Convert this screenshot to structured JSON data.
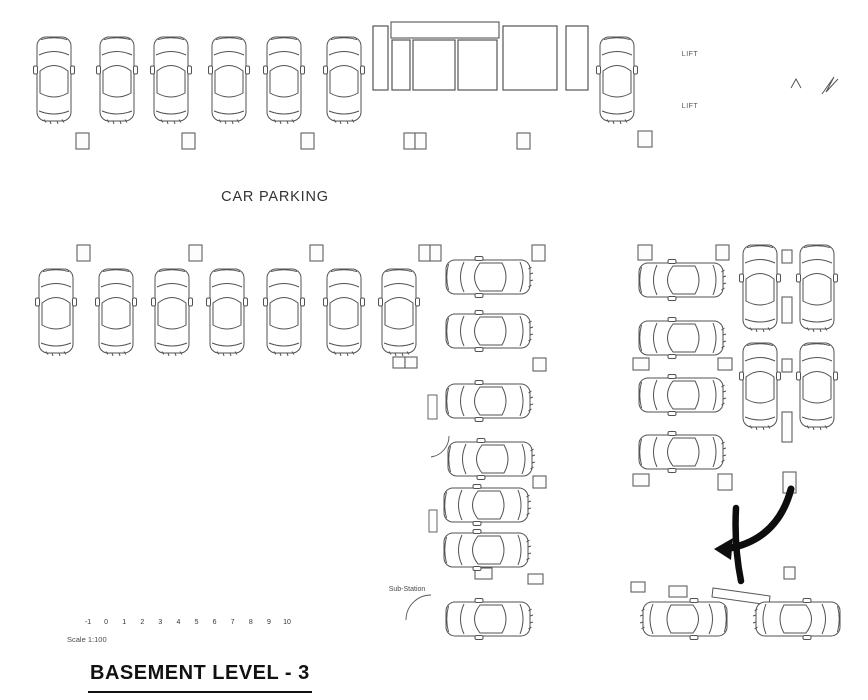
{
  "labels": {
    "car_parking": "CAR PARKING",
    "lift_upper": "LIFT",
    "lift_lower": "LIFT",
    "substation": "Sub-Station",
    "scale_note": "Scale 1:100",
    "title": "BASEMENT LEVEL - 3"
  },
  "colors": {
    "wall": "#3d3d3d",
    "line": "#555555",
    "pillar": "#5f5f5f",
    "car": "#525252",
    "dashdot": "#7a7a7a",
    "arrow": "#0d0d0d",
    "background": "#ffffff",
    "text": "#262626"
  },
  "scale_bar": {
    "labels": [
      "-1",
      "0",
      "1",
      "2",
      "3",
      "4",
      "5",
      "6",
      "7",
      "8",
      "9",
      "10"
    ],
    "x_start": 88,
    "x_end": 287,
    "y": 615,
    "tick_top": 607,
    "tick_bottom": 616
  },
  "geometry": {
    "wall_lines": [
      [
        20,
        15,
        862,
        15
      ],
      [
        29,
        24,
        853,
        24
      ],
      [
        862,
        15,
        862,
        682
      ],
      [
        853,
        24,
        853,
        673
      ],
      [
        862,
        682,
        381,
        646
      ],
      [
        853,
        673,
        388,
        640
      ],
      [
        381,
        646,
        381,
        368
      ],
      [
        387,
        640,
        387,
        368
      ],
      [
        7,
        368,
        437,
        368
      ],
      [
        15,
        358,
        437,
        358
      ],
      [
        7,
        368,
        20,
        15
      ],
      [
        16,
        358,
        29,
        24
      ],
      [
        381,
        565,
        431,
        565
      ],
      [
        381,
        569,
        431,
        569
      ],
      [
        431,
        368,
        431,
        395
      ],
      [
        436,
        368,
        436,
        395
      ],
      [
        431,
        419,
        431,
        436
      ],
      [
        436,
        419,
        436,
        436
      ],
      [
        431,
        436,
        449,
        436
      ],
      [
        431,
        457,
        431,
        594
      ],
      [
        436,
        457,
        436,
        594
      ],
      [
        431,
        620,
        431,
        648
      ],
      [
        436,
        620,
        436,
        648
      ],
      [
        371,
        93,
        590,
        93
      ],
      [
        651,
        25,
        651,
        136
      ],
      [
        655,
        25,
        655,
        136
      ],
      [
        651,
        81,
        731,
        81
      ],
      [
        651,
        85,
        731,
        85
      ],
      [
        651,
        134,
        720,
        134
      ],
      [
        728,
        30,
        728,
        81
      ],
      [
        728,
        95,
        728,
        134
      ],
      [
        722,
        44,
        734,
        44
      ],
      [
        722,
        98,
        734,
        98
      ],
      [
        668,
        134,
        668,
        147
      ],
      [
        779,
        25,
        779,
        140
      ],
      [
        783,
        25,
        783,
        140
      ],
      [
        847,
        25,
        847,
        140
      ],
      [
        779,
        140,
        847,
        140
      ],
      [
        779,
        140,
        779,
        148
      ],
      [
        820,
        143,
        833,
        143
      ],
      [
        833,
        143,
        833,
        148
      ],
      [
        730,
        247,
        730,
        477
      ],
      [
        735,
        247,
        735,
        477
      ],
      [
        843,
        140,
        843,
        477
      ],
      [
        848,
        140,
        848,
        477
      ]
    ],
    "service_rects": [
      [
        373,
        26,
        15,
        64
      ],
      [
        392,
        40,
        18,
        50
      ],
      [
        413,
        40,
        42,
        50
      ],
      [
        458,
        40,
        39,
        50
      ],
      [
        503,
        26,
        54,
        64
      ],
      [
        566,
        26,
        22,
        64
      ]
    ],
    "xbox": {
      "x": 391,
      "y": 22,
      "w": 108,
      "h": 16
    },
    "pillar_rects": [
      [
        76,
        133,
        13,
        16
      ],
      [
        182,
        133,
        13,
        16
      ],
      [
        301,
        133,
        13,
        16
      ],
      [
        404,
        133,
        11,
        16
      ],
      [
        415,
        133,
        11,
        16
      ],
      [
        517,
        133,
        13,
        16
      ],
      [
        638,
        131,
        14,
        16
      ],
      [
        77,
        245,
        13,
        16
      ],
      [
        189,
        245,
        13,
        16
      ],
      [
        310,
        245,
        13,
        16
      ],
      [
        419,
        245,
        11,
        16
      ],
      [
        430,
        245,
        11,
        16
      ],
      [
        532,
        245,
        13,
        16
      ],
      [
        638,
        245,
        14,
        15
      ],
      [
        716,
        245,
        13,
        15
      ],
      [
        393,
        357,
        12,
        11
      ],
      [
        405,
        357,
        12,
        11
      ],
      [
        533,
        358,
        13,
        13
      ],
      [
        633,
        358,
        16,
        12
      ],
      [
        718,
        358,
        14,
        12
      ],
      [
        533,
        476,
        13,
        12
      ],
      [
        633,
        474,
        16,
        12
      ],
      [
        718,
        474,
        14,
        16
      ],
      [
        475,
        568,
        17,
        11
      ],
      [
        528,
        574,
        15,
        10
      ],
      [
        631,
        582,
        14,
        10
      ],
      [
        669,
        586,
        18,
        11
      ],
      [
        782,
        250,
        10,
        13
      ],
      [
        782,
        297,
        10,
        26
      ],
      [
        782,
        359,
        10,
        13
      ],
      [
        782,
        412,
        10,
        30
      ],
      [
        783,
        472,
        13,
        21
      ],
      [
        784,
        567,
        11,
        12
      ]
    ],
    "stair_lines": [
      [
        783,
        48,
        847,
        48
      ],
      [
        783,
        53.6,
        847,
        53.6
      ],
      [
        783,
        59.2,
        847,
        59.2
      ],
      [
        783,
        64.8,
        847,
        64.8
      ],
      [
        783,
        70.4,
        847,
        70.4
      ],
      [
        783,
        76,
        847,
        76
      ],
      [
        783,
        81.6,
        810,
        81.6
      ],
      [
        783,
        87.2,
        810,
        87.2
      ],
      [
        783,
        92.8,
        810,
        92.8
      ],
      [
        783,
        98.4,
        810,
        98.4
      ],
      [
        783,
        104,
        810,
        104
      ],
      [
        783,
        109.6,
        810,
        109.6
      ],
      [
        810,
        48,
        810,
        110
      ],
      [
        818,
        48,
        818,
        110
      ],
      [
        796,
        112,
        796,
        82
      ]
    ],
    "stair_paths": [
      "M 791 88 L 796 79 L 801 88",
      "M 822 94 L 834 77 L 826 92 L 838 79"
    ],
    "door_hash_rects": [
      {
        "rect": [
          428,
          395,
          9,
          24
        ],
        "lines": [
          [
            428,
            401,
            437,
            401
          ],
          [
            428,
            407,
            437,
            407
          ],
          [
            428,
            413,
            437,
            413
          ]
        ]
      },
      {
        "rect": [
          429,
          510,
          8,
          22
        ],
        "lines": [
          [
            429,
            517,
            437,
            517
          ],
          [
            429,
            524,
            437,
            524
          ]
        ]
      }
    ],
    "door_arcs": [
      "M 449 436 A 21 21 0 0 1 431 457",
      "M 431 595 A 25 25 0 0 0 406 620"
    ],
    "dashdot_lines": [
      [
        722,
        479,
        860,
        479
      ],
      [
        722,
        487,
        860,
        487
      ],
      [
        730,
        490,
        730,
        592
      ]
    ],
    "ramp_lines": [
      [
        757,
        589,
        853,
        490
      ],
      [
        763,
        594,
        859,
        495
      ],
      [
        771,
        600,
        861,
        506
      ],
      [
        716,
        591,
        766,
        599
      ]
    ],
    "curb_polygon": "713,588 770,596 769,605 712,597",
    "arrow": {
      "arc": "M 791 489 Q 778 538 731 548",
      "tail": "M 736 508 Q 734 546 741 581",
      "head_points": "714,549 733,538 731,560"
    },
    "cars": [
      {
        "x": 54,
        "y": 79,
        "r": 0
      },
      {
        "x": 117,
        "y": 79,
        "r": 0
      },
      {
        "x": 171,
        "y": 79,
        "r": 0
      },
      {
        "x": 229,
        "y": 79,
        "r": 0
      },
      {
        "x": 284,
        "y": 79,
        "r": 0
      },
      {
        "x": 344,
        "y": 79,
        "r": 0
      },
      {
        "x": 617,
        "y": 79,
        "r": 0
      },
      {
        "x": 56,
        "y": 311,
        "r": 0
      },
      {
        "x": 116,
        "y": 311,
        "r": 0
      },
      {
        "x": 172,
        "y": 311,
        "r": 0
      },
      {
        "x": 227,
        "y": 311,
        "r": 0
      },
      {
        "x": 284,
        "y": 311,
        "r": 0
      },
      {
        "x": 344,
        "y": 311,
        "r": 0
      },
      {
        "x": 399,
        "y": 311,
        "r": 0
      },
      {
        "x": 488,
        "y": 277,
        "r": -90
      },
      {
        "x": 488,
        "y": 331,
        "r": -90
      },
      {
        "x": 488,
        "y": 401,
        "r": -90
      },
      {
        "x": 490,
        "y": 459,
        "r": -90
      },
      {
        "x": 486,
        "y": 505,
        "r": -90
      },
      {
        "x": 486,
        "y": 550,
        "r": -90
      },
      {
        "x": 488,
        "y": 619,
        "r": -90
      },
      {
        "x": 681,
        "y": 280,
        "r": -90
      },
      {
        "x": 681,
        "y": 338,
        "r": -90
      },
      {
        "x": 681,
        "y": 395,
        "r": -90
      },
      {
        "x": 681,
        "y": 452,
        "r": -90
      },
      {
        "x": 760,
        "y": 287,
        "r": 0
      },
      {
        "x": 760,
        "y": 385,
        "r": 0
      },
      {
        "x": 817,
        "y": 287,
        "r": 0
      },
      {
        "x": 817,
        "y": 385,
        "r": 0
      },
      {
        "x": 685,
        "y": 619,
        "r": 90
      },
      {
        "x": 798,
        "y": 619,
        "r": 90
      }
    ],
    "xbox_note": "crossed duct shaft",
    "title_underline": {
      "x": 88,
      "y": 691,
      "w": 224
    }
  }
}
